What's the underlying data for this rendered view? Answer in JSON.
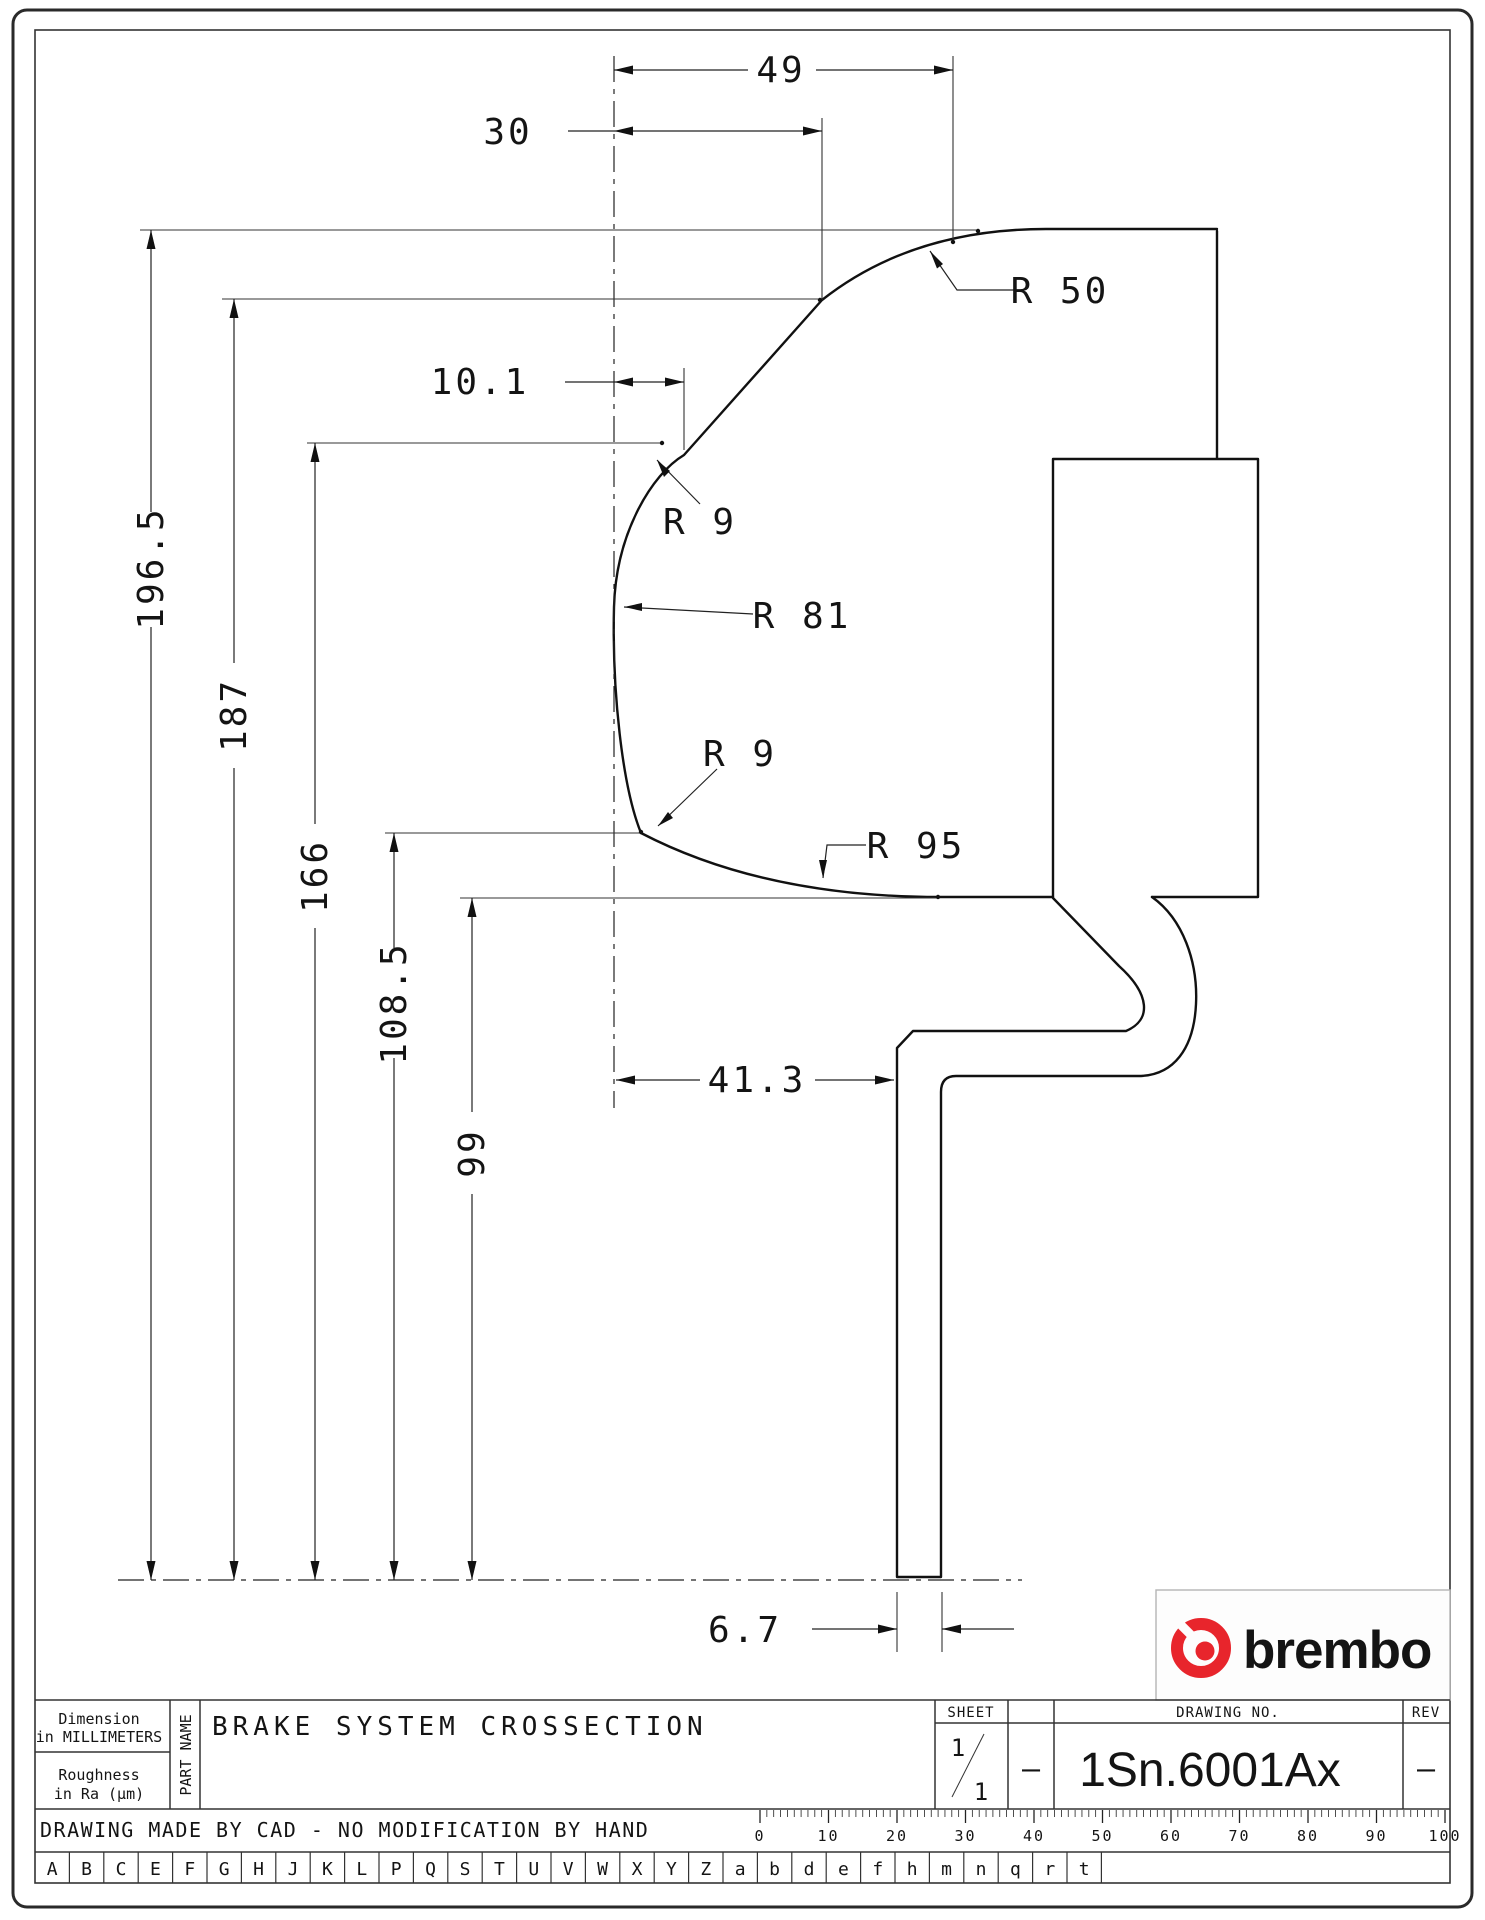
{
  "dims": {
    "h49": "49",
    "h30": "30",
    "h10_1": "10.1",
    "h41_3": "41.3",
    "h6_7": "6.7",
    "v196_5": "196.5",
    "v187": "187",
    "v166": "166",
    "v108_5": "108.5",
    "v99": "99",
    "r50": "R 50",
    "r9_upper": "R 9",
    "r81": "R 81",
    "r9_lower": "R 9",
    "r95": "R 95"
  },
  "title_block": {
    "dimension_note_line1": "Dimension",
    "dimension_note_line2": "in MILLIMETERS",
    "roughness_line1": "Roughness",
    "roughness_line2": "in Ra (μm)",
    "part_name_label": "PART NAME",
    "part_name": "BRAKE SYSTEM CROSSECTION",
    "sheet_label": "SHEET",
    "sheet_numerator": "1",
    "sheet_denominator": "1",
    "sheet_dash": "–",
    "drawing_no_label": "DRAWING NO.",
    "drawing_no": "1Sn.6001Ax",
    "rev_label": "REV",
    "rev_value": "–"
  },
  "footer": {
    "note": "DRAWING MADE BY CAD - NO MODIFICATION BY HAND",
    "ruler_labels": [
      "0",
      "10",
      "20",
      "30",
      "40",
      "50",
      "60",
      "70",
      "80",
      "90",
      "100"
    ],
    "letters": [
      "A",
      "B",
      "C",
      "E",
      "F",
      "G",
      "H",
      "J",
      "K",
      "L",
      "P",
      "Q",
      "S",
      "T",
      "U",
      "V",
      "W",
      "X",
      "Y",
      "Z",
      "a",
      "b",
      "d",
      "e",
      "f",
      "h",
      "m",
      "n",
      "q",
      "r",
      "t"
    ]
  },
  "logo": {
    "text": "brembo",
    "color": "#e8252c"
  }
}
